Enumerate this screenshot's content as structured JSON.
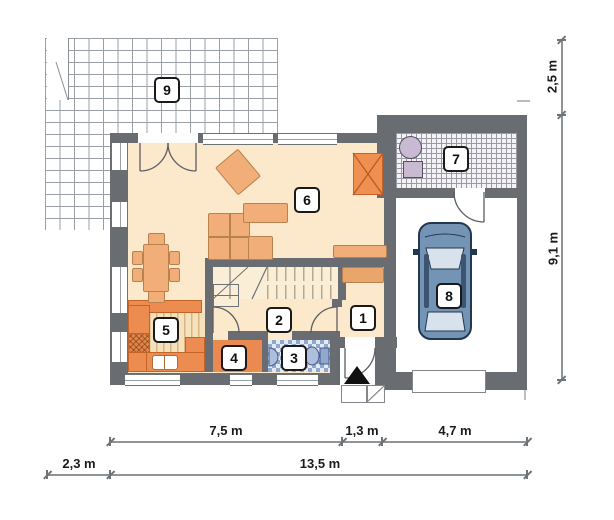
{
  "rooms": {
    "r1": {
      "label": "1"
    },
    "r2": {
      "label": "2"
    },
    "r3": {
      "label": "3"
    },
    "r4": {
      "label": "4"
    },
    "r5": {
      "label": "5"
    },
    "r6": {
      "label": "6"
    },
    "r7": {
      "label": "7"
    },
    "r8": {
      "label": "8"
    },
    "r9": {
      "label": "9"
    }
  },
  "dimensions": {
    "top_row": [
      {
        "label": "7,5 m"
      },
      {
        "label": "1,3 m"
      },
      {
        "label": "4,7 m"
      }
    ],
    "bottom_row": [
      {
        "label": "2,3 m"
      },
      {
        "label": "13,5 m"
      }
    ],
    "right_column": [
      {
        "label": "2,5 m"
      },
      {
        "label": "9,1 m"
      }
    ]
  },
  "objects": [
    "terrace-grid",
    "corner-sofa",
    "armchair",
    "coffee-table",
    "sideboard",
    "fireplace",
    "dining-table",
    "dining-chair",
    "kitchen-counter",
    "hob",
    "kitchen-sink",
    "staircase",
    "wardrobe",
    "washbasin",
    "toilet",
    "boiler",
    "water-heater",
    "car-top-view",
    "entrance-arrow",
    "garage-door",
    "entry-steps",
    "door-swing"
  ],
  "colors": {
    "wall": "#696d72",
    "floor": "#fce8ca",
    "furn": "#f2ae79",
    "furn_border": "#b8824f",
    "counter": "#ec8c50",
    "counter_border": "#c4642a",
    "car_body": "#7494b5",
    "car_dark": "#23384e",
    "glass": "#d7e2ec",
    "tile": "#8fa8cc",
    "fixture": "#c9bad3",
    "grid_line": "#9aa0a6",
    "dim_line": "#8f9499",
    "dim_tick": "#6f7479",
    "text": "#1b1b1b"
  }
}
